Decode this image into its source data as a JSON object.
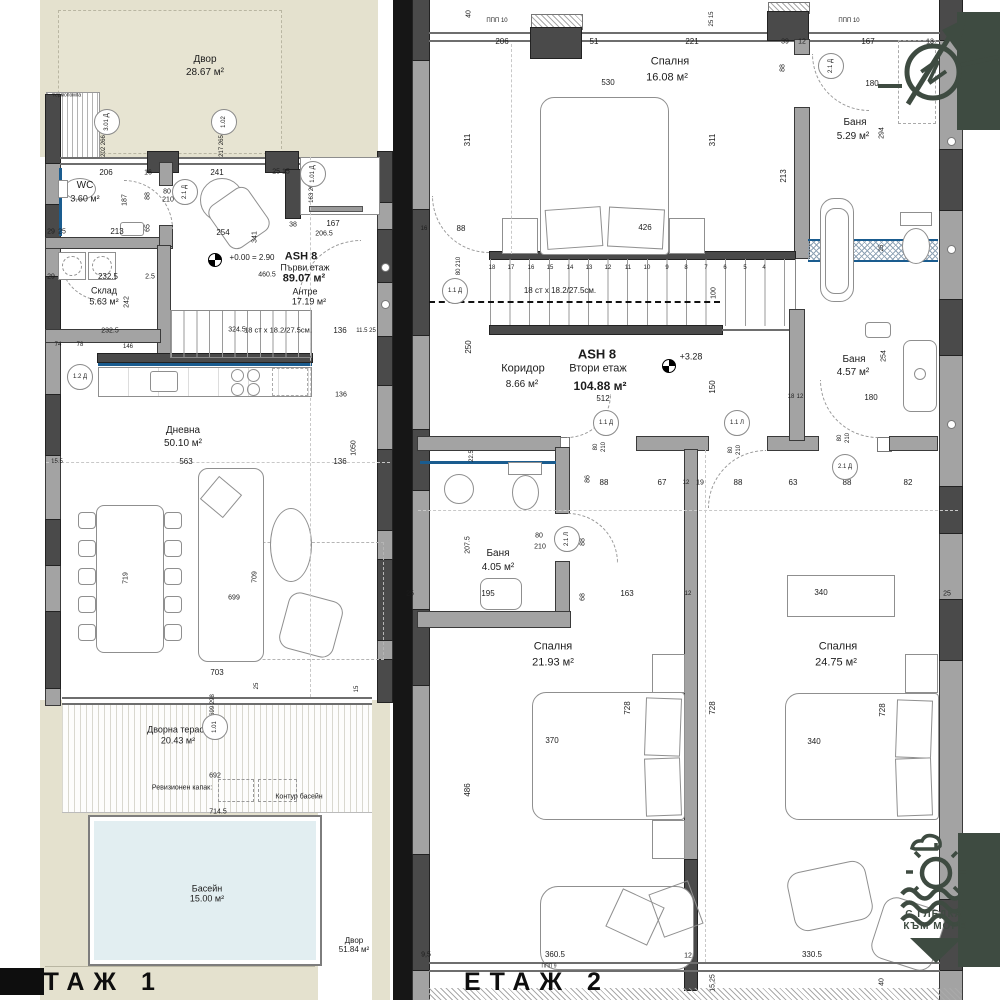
{
  "palette": {
    "ground": "#e4e1ce",
    "pool": "#e2eef1",
    "wall": "#a3a3a3",
    "wall_dark": "#4a4a4a",
    "accent_green": "#3e4b41",
    "accent_blue": "#1a5c8f",
    "divider": "#161616"
  },
  "floor1": {
    "title": "ЕТАЖ 1",
    "texts": [
      {
        "t": "Двор",
        "x": 205,
        "y": 60,
        "s": 10,
        "n": "room-label"
      },
      {
        "t": "28.67 м²",
        "x": 205,
        "y": 73,
        "s": 10,
        "n": "room-area"
      },
      {
        "t": "WC",
        "x": 85,
        "y": 186,
        "s": 10,
        "n": "room-label"
      },
      {
        "t": "3.60 м²",
        "x": 85,
        "y": 199,
        "s": 9,
        "n": "room-area"
      },
      {
        "t": "Склад",
        "x": 104,
        "y": 291,
        "s": 9,
        "n": "room-label"
      },
      {
        "t": "5.63 м²",
        "x": 104,
        "y": 302,
        "s": 9,
        "n": "room-area"
      },
      {
        "t": "ASH 8",
        "x": 301,
        "y": 257,
        "s": 11,
        "b": 1,
        "n": "unit-label"
      },
      {
        "t": "Първи  етаж",
        "x": 305,
        "y": 268,
        "s": 9,
        "n": "room-label"
      },
      {
        "t": "89.07 м²",
        "x": 304,
        "y": 279,
        "s": 11,
        "b": 1,
        "n": "room-area"
      },
      {
        "t": "Антре",
        "x": 305,
        "y": 292,
        "s": 9,
        "n": "room-label"
      },
      {
        "t": "17.19 м²",
        "x": 309,
        "y": 302,
        "s": 9,
        "n": "room-area"
      },
      {
        "t": "Дневна",
        "x": 183,
        "y": 431,
        "s": 10,
        "n": "room-label"
      },
      {
        "t": "50.10 м²",
        "x": 183,
        "y": 444,
        "s": 10,
        "n": "room-area"
      },
      {
        "t": "Дворна тераса",
        "x": 178,
        "y": 730,
        "s": 9,
        "n": "room-label"
      },
      {
        "t": "20.43 м²",
        "x": 178,
        "y": 741,
        "s": 9,
        "n": "room-area"
      },
      {
        "t": "Басейн",
        "x": 207,
        "y": 889,
        "s": 9,
        "n": "room-label"
      },
      {
        "t": "15.00 м²",
        "x": 207,
        "y": 899,
        "s": 9,
        "n": "room-area"
      },
      {
        "t": "Двор",
        "x": 354,
        "y": 941,
        "s": 8,
        "n": "room-label"
      },
      {
        "t": "51.84 м²",
        "x": 354,
        "y": 950,
        "s": 8,
        "n": "room-area"
      },
      {
        "t": "термопомпа",
        "x": 67,
        "y": 96,
        "s": 5,
        "n": "note"
      },
      {
        "t": "Ревизионен капак:",
        "x": 182,
        "y": 788,
        "s": 7,
        "n": "note"
      },
      {
        "t": "Контур басейн",
        "x": 299,
        "y": 797,
        "s": 7,
        "n": "note"
      },
      {
        "t": "+0.00 = 2.90",
        "x": 252,
        "y": 258,
        "s": 8,
        "n": "level-note"
      },
      {
        "t": "18 ст x 18.2/27.5см.",
        "x": 278,
        "y": 330,
        "s": 7.5,
        "n": "stairs-note"
      },
      {
        "t": "206",
        "x": 106,
        "y": 173
      },
      {
        "t": "16",
        "x": 148,
        "y": 173,
        "s": 7
      },
      {
        "t": "241",
        "x": 217,
        "y": 173
      },
      {
        "t": "25 15",
        "x": 281,
        "y": 172,
        "s": 7
      },
      {
        "t": "187",
        "x": 125,
        "y": 200,
        "r": -90,
        "s": 7
      },
      {
        "t": "88",
        "x": 148,
        "y": 196,
        "r": -90,
        "s": 7
      },
      {
        "t": "80",
        "x": 167,
        "y": 192,
        "s": 7
      },
      {
        "t": "210",
        "x": 168,
        "y": 200,
        "s": 7
      },
      {
        "t": "213",
        "x": 117,
        "y": 232
      },
      {
        "t": "65",
        "x": 148,
        "y": 228,
        "r": -90,
        "s": 7
      },
      {
        "t": "254",
        "x": 223,
        "y": 233
      },
      {
        "t": "341",
        "x": 255,
        "y": 237,
        "r": -90,
        "s": 7
      },
      {
        "t": "38",
        "x": 293,
        "y": 225,
        "s": 7
      },
      {
        "t": "167",
        "x": 333,
        "y": 224
      },
      {
        "t": "206.5",
        "x": 324,
        "y": 234,
        "s": 7
      },
      {
        "t": "163 265",
        "x": 312,
        "y": 192,
        "r": -90,
        "s": 6
      },
      {
        "t": "202 266",
        "x": 104,
        "y": 146,
        "r": -90,
        "s": 6
      },
      {
        "t": "217 265",
        "x": 222,
        "y": 146,
        "r": -90,
        "s": 6
      },
      {
        "t": "29",
        "x": 51,
        "y": 232,
        "s": 7
      },
      {
        "t": "25",
        "x": 62,
        "y": 232,
        "s": 7
      },
      {
        "t": "29",
        "x": 51,
        "y": 277,
        "s": 7
      },
      {
        "t": "232.5",
        "x": 108,
        "y": 277
      },
      {
        "t": "2.5",
        "x": 150,
        "y": 277,
        "s": 7
      },
      {
        "t": "460.5",
        "x": 267,
        "y": 275,
        "s": 7
      },
      {
        "t": "242",
        "x": 127,
        "y": 302,
        "r": -90,
        "s": 7
      },
      {
        "t": "74",
        "x": 58,
        "y": 345,
        "s": 6
      },
      {
        "t": "78",
        "x": 80,
        "y": 345,
        "s": 6
      },
      {
        "t": "146",
        "x": 128,
        "y": 347,
        "s": 6
      },
      {
        "t": "232.5",
        "x": 110,
        "y": 331,
        "s": 7
      },
      {
        "t": "324.5",
        "x": 237,
        "y": 330,
        "s": 7
      },
      {
        "t": "136",
        "x": 340,
        "y": 331
      },
      {
        "t": "11.5 25",
        "x": 366,
        "y": 331,
        "s": 6
      },
      {
        "t": "563",
        "x": 186,
        "y": 462
      },
      {
        "t": "136",
        "x": 340,
        "y": 462
      },
      {
        "t": "15.5",
        "x": 57,
        "y": 462,
        "s": 6
      },
      {
        "t": "136",
        "x": 341,
        "y": 395,
        "s": 7
      },
      {
        "t": "1050",
        "x": 354,
        "y": 448,
        "r": -90,
        "s": 7
      },
      {
        "t": "719",
        "x": 126,
        "y": 578,
        "r": -90,
        "s": 7
      },
      {
        "t": "709",
        "x": 255,
        "y": 577,
        "r": -90,
        "s": 7
      },
      {
        "t": "699",
        "x": 234,
        "y": 598,
        "s": 7
      },
      {
        "t": "703",
        "x": 217,
        "y": 673
      },
      {
        "t": "699 298",
        "x": 213,
        "y": 705,
        "r": -90,
        "s": 6
      },
      {
        "t": "692",
        "x": 215,
        "y": 776,
        "s": 7
      },
      {
        "t": "714.5",
        "x": 218,
        "y": 812,
        "s": 7
      },
      {
        "t": "25",
        "x": 257,
        "y": 686,
        "r": -90,
        "s": 6
      },
      {
        "t": "15",
        "x": 357,
        "y": 689,
        "r": -90,
        "s": 6
      }
    ],
    "tags": [
      {
        "t": "3.01 Д",
        "x": 107,
        "y": 122,
        "r": -90
      },
      {
        "t": "1.02",
        "x": 224,
        "y": 122,
        "r": -90
      },
      {
        "t": "1.01 Д",
        "x": 313,
        "y": 174,
        "r": -90
      },
      {
        "t": "2.1 Д",
        "x": 185,
        "y": 192,
        "r": -90
      },
      {
        "t": "1.2 Д",
        "x": 80,
        "y": 377
      },
      {
        "t": "1.01",
        "x": 215,
        "y": 727,
        "r": -90
      }
    ]
  },
  "floor2": {
    "title": "ЕТАЖ 2",
    "texts": [
      {
        "t": "Спалня",
        "x": 670,
        "y": 62,
        "s": 11,
        "n": "room-label"
      },
      {
        "t": "16.08 м²",
        "x": 667,
        "y": 78,
        "s": 11,
        "n": "room-area"
      },
      {
        "t": "Баня",
        "x": 855,
        "y": 123,
        "s": 10,
        "n": "room-label"
      },
      {
        "t": "5.29 м²",
        "x": 853,
        "y": 137,
        "s": 10,
        "n": "room-area"
      },
      {
        "t": "ASH 8",
        "x": 597,
        "y": 354,
        "s": 13,
        "b": 1,
        "n": "unit-label"
      },
      {
        "t": "Коридор",
        "x": 523,
        "y": 369,
        "s": 11,
        "n": "room-label"
      },
      {
        "t": "Втори  етаж",
        "x": 598,
        "y": 369,
        "s": 11,
        "n": "room-label"
      },
      {
        "t": "8.66 м²",
        "x": 522,
        "y": 385,
        "s": 10,
        "n": "room-area"
      },
      {
        "t": "104.88 м²",
        "x": 600,
        "y": 386,
        "s": 12,
        "b": 1,
        "n": "room-area"
      },
      {
        "t": "512",
        "x": 603,
        "y": 399,
        "s": 8
      },
      {
        "t": "+3.28",
        "x": 691,
        "y": 357,
        "s": 9,
        "n": "level-note"
      },
      {
        "t": "Баня",
        "x": 854,
        "y": 360,
        "s": 10,
        "n": "room-label"
      },
      {
        "t": "4.57 м²",
        "x": 853,
        "y": 373,
        "s": 10,
        "n": "room-area"
      },
      {
        "t": "Баня",
        "x": 498,
        "y": 554,
        "s": 10,
        "n": "room-label"
      },
      {
        "t": "4.05 м²",
        "x": 498,
        "y": 568,
        "s": 10,
        "n": "room-area"
      },
      {
        "t": "Спалня",
        "x": 553,
        "y": 647,
        "s": 11,
        "n": "room-label"
      },
      {
        "t": "21.93 м²",
        "x": 553,
        "y": 663,
        "s": 11,
        "n": "room-area"
      },
      {
        "t": "Спалня",
        "x": 838,
        "y": 647,
        "s": 11,
        "n": "room-label"
      },
      {
        "t": "24.75 м²",
        "x": 836,
        "y": 663,
        "s": 11,
        "n": "room-area"
      },
      {
        "t": "18 ст x 18.2/27.5см.",
        "x": 560,
        "y": 291,
        "s": 8,
        "n": "stairs-note"
      },
      {
        "t": "ППП 10",
        "x": 497,
        "y": 21,
        "s": 6,
        "n": "note"
      },
      {
        "t": "ППП 10",
        "x": 849,
        "y": 21,
        "s": 6,
        "n": "note"
      },
      {
        "t": "ППП 9",
        "x": 549,
        "y": 967,
        "s": 5,
        "n": "note"
      },
      {
        "t": "40",
        "x": 469,
        "y": 14,
        "r": -90,
        "s": 7
      },
      {
        "t": "206",
        "x": 502,
        "y": 42
      },
      {
        "t": "51",
        "x": 594,
        "y": 42
      },
      {
        "t": "221",
        "x": 692,
        "y": 42
      },
      {
        "t": "39",
        "x": 785,
        "y": 42,
        "s": 7
      },
      {
        "t": "12",
        "x": 802,
        "y": 42,
        "s": 7
      },
      {
        "t": "167",
        "x": 868,
        "y": 42
      },
      {
        "t": "25 15",
        "x": 712,
        "y": 19,
        "r": -90,
        "s": 6
      },
      {
        "t": "530",
        "x": 608,
        "y": 83
      },
      {
        "t": "311",
        "x": 468,
        "y": 140,
        "r": -90
      },
      {
        "t": "311",
        "x": 713,
        "y": 140,
        "r": -90
      },
      {
        "t": "88",
        "x": 783,
        "y": 68,
        "r": -90,
        "s": 7
      },
      {
        "t": "80",
        "x": 830,
        "y": 58,
        "s": 7
      },
      {
        "t": "210",
        "x": 832,
        "y": 69,
        "s": 7
      },
      {
        "t": "180",
        "x": 872,
        "y": 84,
        "s": 8
      },
      {
        "t": "294",
        "x": 882,
        "y": 133,
        "r": -90,
        "s": 7
      },
      {
        "t": "13",
        "x": 930,
        "y": 42,
        "s": 7
      },
      {
        "t": "213",
        "x": 784,
        "y": 176,
        "r": -90
      },
      {
        "t": "88",
        "x": 461,
        "y": 229,
        "s": 8
      },
      {
        "t": "16",
        "x": 424,
        "y": 229,
        "s": 6
      },
      {
        "t": "426",
        "x": 645,
        "y": 228
      },
      {
        "t": "80 210",
        "x": 459,
        "y": 266,
        "r": -90,
        "s": 6
      },
      {
        "t": "25",
        "x": 882,
        "y": 248,
        "r": -90,
        "s": 6
      },
      {
        "t": "100",
        "x": 714,
        "y": 293,
        "r": -90,
        "s": 7
      },
      {
        "t": "250",
        "x": 469,
        "y": 347,
        "r": -90
      },
      {
        "t": "150",
        "x": 713,
        "y": 387,
        "r": -90
      },
      {
        "t": "254",
        "x": 884,
        "y": 356,
        "r": -90,
        "s": 7
      },
      {
        "t": "180",
        "x": 871,
        "y": 398,
        "s": 8
      },
      {
        "t": "18",
        "x": 791,
        "y": 397,
        "s": 6
      },
      {
        "t": "12",
        "x": 800,
        "y": 397,
        "s": 6
      },
      {
        "t": "22.5",
        "x": 472,
        "y": 456,
        "r": -90,
        "s": 6
      },
      {
        "t": "80",
        "x": 596,
        "y": 447,
        "r": -90,
        "s": 6
      },
      {
        "t": "210",
        "x": 604,
        "y": 447,
        "r": -90,
        "s": 6
      },
      {
        "t": "80",
        "x": 731,
        "y": 450,
        "r": -90,
        "s": 6
      },
      {
        "t": "210",
        "x": 739,
        "y": 450,
        "r": -90,
        "s": 6
      },
      {
        "t": "80",
        "x": 840,
        "y": 438,
        "r": -90,
        "s": 6
      },
      {
        "t": "210",
        "x": 848,
        "y": 438,
        "r": -90,
        "s": 6
      },
      {
        "t": "86",
        "x": 588,
        "y": 479,
        "r": -90,
        "s": 7
      },
      {
        "t": "88",
        "x": 604,
        "y": 483
      },
      {
        "t": "67",
        "x": 662,
        "y": 483
      },
      {
        "t": "12",
        "x": 686,
        "y": 483,
        "s": 6
      },
      {
        "t": "19",
        "x": 700,
        "y": 483,
        "s": 7
      },
      {
        "t": "88",
        "x": 738,
        "y": 483
      },
      {
        "t": "63",
        "x": 793,
        "y": 483
      },
      {
        "t": "88",
        "x": 847,
        "y": 483
      },
      {
        "t": "82",
        "x": 908,
        "y": 483
      },
      {
        "t": "80",
        "x": 539,
        "y": 536,
        "s": 7
      },
      {
        "t": "210",
        "x": 540,
        "y": 547,
        "s": 7
      },
      {
        "t": "88",
        "x": 583,
        "y": 542,
        "r": -90,
        "s": 7
      },
      {
        "t": "207.5",
        "x": 468,
        "y": 545,
        "r": -90,
        "s": 7
      },
      {
        "t": "195",
        "x": 488,
        "y": 594
      },
      {
        "t": "68",
        "x": 583,
        "y": 597,
        "r": -90,
        "s": 7
      },
      {
        "t": "163",
        "x": 627,
        "y": 594
      },
      {
        "t": "12",
        "x": 688,
        "y": 594,
        "s": 6
      },
      {
        "t": "25",
        "x": 410,
        "y": 594,
        "s": 7
      },
      {
        "t": "25",
        "x": 947,
        "y": 594,
        "s": 7
      },
      {
        "t": "340",
        "x": 821,
        "y": 593
      },
      {
        "t": "370",
        "x": 552,
        "y": 741
      },
      {
        "t": "728",
        "x": 628,
        "y": 708,
        "r": -90
      },
      {
        "t": "728",
        "x": 713,
        "y": 708,
        "r": -90
      },
      {
        "t": "486",
        "x": 468,
        "y": 790,
        "r": -90
      },
      {
        "t": "340",
        "x": 814,
        "y": 742
      },
      {
        "t": "728",
        "x": 883,
        "y": 710,
        "r": -90
      },
      {
        "t": "360.5",
        "x": 555,
        "y": 955
      },
      {
        "t": "9,5",
        "x": 426,
        "y": 955,
        "s": 7
      },
      {
        "t": "12",
        "x": 688,
        "y": 956,
        "s": 7
      },
      {
        "t": "15,25",
        "x": 713,
        "y": 983,
        "r": -90,
        "s": 7
      },
      {
        "t": "330.5",
        "x": 812,
        "y": 955
      },
      {
        "t": "40",
        "x": 882,
        "y": 982,
        "r": -90,
        "s": 7
      }
    ],
    "tags": [
      {
        "t": "1.1 Д",
        "x": 455,
        "y": 291
      },
      {
        "t": "1.1 Д",
        "x": 606,
        "y": 423
      },
      {
        "t": "1.1 Л",
        "x": 737,
        "y": 423
      },
      {
        "t": "2.1 Д",
        "x": 845,
        "y": 467
      },
      {
        "t": "2.1 Л",
        "x": 567,
        "y": 539,
        "r": -90
      },
      {
        "t": "2.1 Д",
        "x": 831,
        "y": 66,
        "r": -90
      }
    ],
    "stair_numbers": [
      {
        "t": "18",
        "x": 492,
        "y": 268,
        "s": 6
      },
      {
        "t": "17",
        "x": 511,
        "y": 268,
        "s": 6
      },
      {
        "t": "16",
        "x": 531,
        "y": 268,
        "s": 6
      },
      {
        "t": "15",
        "x": 550,
        "y": 268,
        "s": 6
      },
      {
        "t": "14",
        "x": 570,
        "y": 268,
        "s": 6
      },
      {
        "t": "13",
        "x": 589,
        "y": 268,
        "s": 6
      },
      {
        "t": "12",
        "x": 608,
        "y": 268,
        "s": 6
      },
      {
        "t": "11",
        "x": 628,
        "y": 268,
        "s": 6
      },
      {
        "t": "10",
        "x": 647,
        "y": 268,
        "s": 6
      },
      {
        "t": "9",
        "x": 667,
        "y": 268,
        "s": 6
      },
      {
        "t": "8",
        "x": 686,
        "y": 268,
        "s": 6
      },
      {
        "t": "7",
        "x": 706,
        "y": 268,
        "s": 6
      },
      {
        "t": "6",
        "x": 725,
        "y": 268,
        "s": 6
      },
      {
        "t": "5",
        "x": 745,
        "y": 268,
        "s": 6
      },
      {
        "t": "4",
        "x": 764,
        "y": 268,
        "s": 6
      }
    ]
  },
  "compass": {
    "letter": "N"
  },
  "logo": {
    "line1": "С ГЛЕДКА",
    "line2": "КЪМ МОРЕ"
  }
}
